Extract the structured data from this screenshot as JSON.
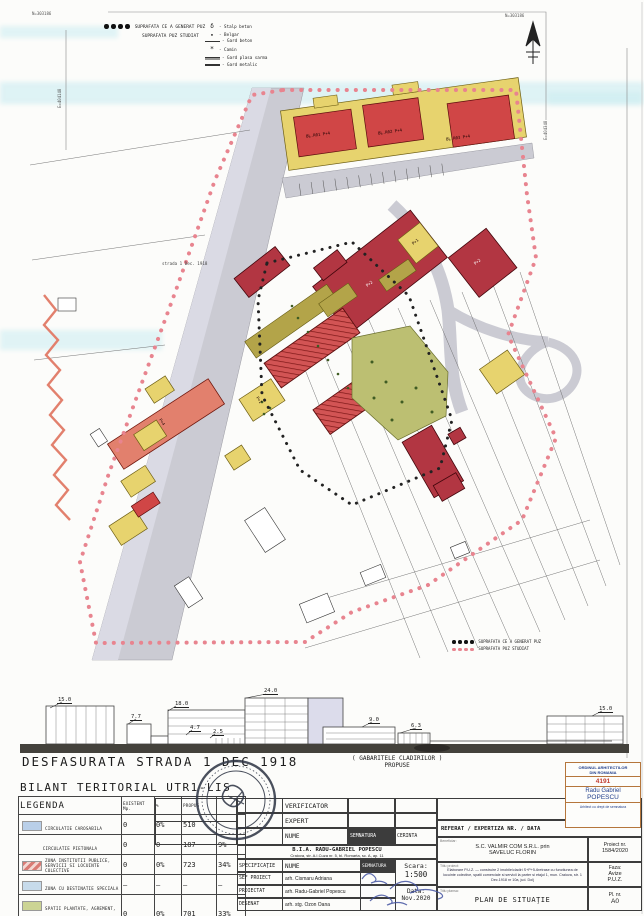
{
  "map": {
    "palette": {
      "street": "#cbcbd3",
      "street_light": "#dadae4",
      "block_yellow": "#e7d36e",
      "block_red": "#d04646",
      "institution": "#b23642",
      "salmon": "#e2806d",
      "green": "#bcbf72",
      "olive": "#b3a449",
      "puz_pink": "#e8848f",
      "generator_black": "#222222",
      "water_cyan": "#bfe9ef"
    },
    "coords": {
      "top_left": "N=303186",
      "top_right": "N=303186",
      "left": "E=404148",
      "right": "E=404348"
    },
    "street_label": "strada 1 Dec. 1918",
    "legend_top": {
      "line1": "SUPRAFATA CE A GENERAT PUZ",
      "line2": "SUPRAFATA PUZ STUDIAT",
      "symbols": [
        {
          "glyph": "δ",
          "label": "- Stalp beton"
        },
        {
          "glyph": "▪",
          "label": "- Belgar"
        },
        {
          "glyph": "",
          "label": "- Gard beton"
        },
        {
          "glyph": "*",
          "label": "- Camin"
        },
        {
          "glyph": "",
          "label": "- Gard plasa sarma"
        },
        {
          "glyph": "",
          "label": "- Gard metalic"
        }
      ]
    },
    "legend_bottom": {
      "line1": "SUPRAFATA CE A GENERAT PUZ",
      "line2": "SUPRAFATA PUZ STUDIAT"
    },
    "labels": [
      {
        "text": "BL.R01 P+4"
      },
      {
        "text": "BL.R02 P+4"
      },
      {
        "text": "BL.R03 P+4"
      },
      {
        "text": "P+2"
      },
      {
        "text": "P+1"
      },
      {
        "text": "P+4"
      },
      {
        "text": "P+1"
      },
      {
        "text": "P+2"
      }
    ]
  },
  "elevation": {
    "title": "DESFASURATA STRADA 1 DEC 1918",
    "note_line1": "( GABARITELE   CLADIRILOR )",
    "note_line2": "PROPUSE",
    "heights": [
      "15.0",
      "7.7",
      "18.0",
      "4.7",
      "2.5",
      "24.0",
      "9.0",
      "6.3",
      "15.0"
    ]
  },
  "bilant": {
    "title": "BILANT TERITORIAL UTR1-LIS",
    "headers": [
      "LEGENDA",
      "EXISTENT Mp.",
      "%",
      "PROPUS",
      ""
    ],
    "rows": [
      {
        "label": "CIRCULATIE CAROSABILA",
        "swatch_css": "#b9cfe8",
        "existent": "0",
        "pct": "0%",
        "propus": "510",
        "ppct": ""
      },
      {
        "label": "CIRCULATIE PIETONALA",
        "swatch_css": "",
        "existent": "0",
        "pct": "0",
        "propus": "187",
        "ppct": "9%"
      },
      {
        "label": "ZONA INSTITUTII PUBLICE, SERVICII SI LOCUINTE COLECTIVE",
        "swatch_css": "repeating-linear-gradient(135deg,#d97b74 0 3px,#f3d7d2 3px 6px)",
        "existent": "0",
        "pct": "0%",
        "propus": "723",
        "ppct": "34%"
      },
      {
        "label": "ZONA CU DESTINATIE SPECIALA",
        "swatch_css": "#c7dbeb",
        "existent": "–",
        "pct": "–",
        "propus": "–",
        "ppct": "–"
      },
      {
        "label": "SPATII PLANTATE, AGREMENT, SPORT",
        "swatch_css": "#ccd494",
        "existent": "0",
        "pct": "0%",
        "propus": "701",
        "ppct": "33%"
      },
      {
        "label": "SUPRAFATA CE A GENERAT PUZ",
        "swatch_css": "",
        "existent": "0",
        "pct": "0",
        "propus": "2126",
        "ppct": "100%"
      }
    ]
  },
  "titleblock": {
    "verificator": "VERIFICATOR",
    "expert": "EXPERT",
    "nume": "NUME",
    "semnatura": "SEMNATURA",
    "cerinta": "CERINTA",
    "referat": "REFERAT / EXPERTIZA NR. / DATA",
    "bia_line1": "B.I.A. RADU-GABRIEL POPESCU",
    "bia_line2": "Craiova, str. A.I.Cuza nr. 5, bl. Romarta, sc. A, ap. 11",
    "specificatie": "SPECIFICAŢIE",
    "nume2": "NUME",
    "semnatura2": "SEMNATURA",
    "sef_proiect_label": "SEF PROIECT",
    "sef_proiect": "arh. Cismaru Adriana",
    "proiectat_label": "PROIECTAT",
    "proiectat": "arh. Radu-Gabriel Popescu",
    "desenat_label": "DESENAT",
    "desenat": "arh. stg. Ozon Oana",
    "scara_label": "Scara:",
    "scara": "1:500",
    "data_label": "Data:",
    "data": "Nov.2020",
    "beneficiar_label": "Beneficiar:",
    "beneficiar_line1": "S.C. VALMIR COM S.R.L. prin",
    "beneficiar_line2": "SAVELUC FLORIN",
    "proiect_nr_label": "Proiect nr.",
    "proiect_nr": "1584/2020",
    "titlu_proiect_label": "Titlu proiect:",
    "titlu_proiect": "Elaborare P.U.Z. — construire 2 imobile/cladiri S+P+5-6retrase cu functiunea de locuinte colective, spatii comerciale si servicii la parter si etajul 1, mun. Craiova, str. 1 Dec.1918 nr 10a, jud. Dolj",
    "faza_label": "Faza:",
    "faza_line1": "Avize",
    "faza_line2": "P.U.Z.",
    "titlu_plansa_label": "Titlu plansa:",
    "titlu_plansa": "PLAN DE SITUAŢIE",
    "pl_label": "Pl. nr.",
    "pl": "A0"
  },
  "oar_stamp": {
    "line1": "ORDINUL ARHITECTILOR",
    "line2": "DIN ROMANIA",
    "number": "4191",
    "name1": "Radu Gabriel",
    "name2": "POPESCU",
    "line3": "Arhitect cu drept de semnatura"
  }
}
